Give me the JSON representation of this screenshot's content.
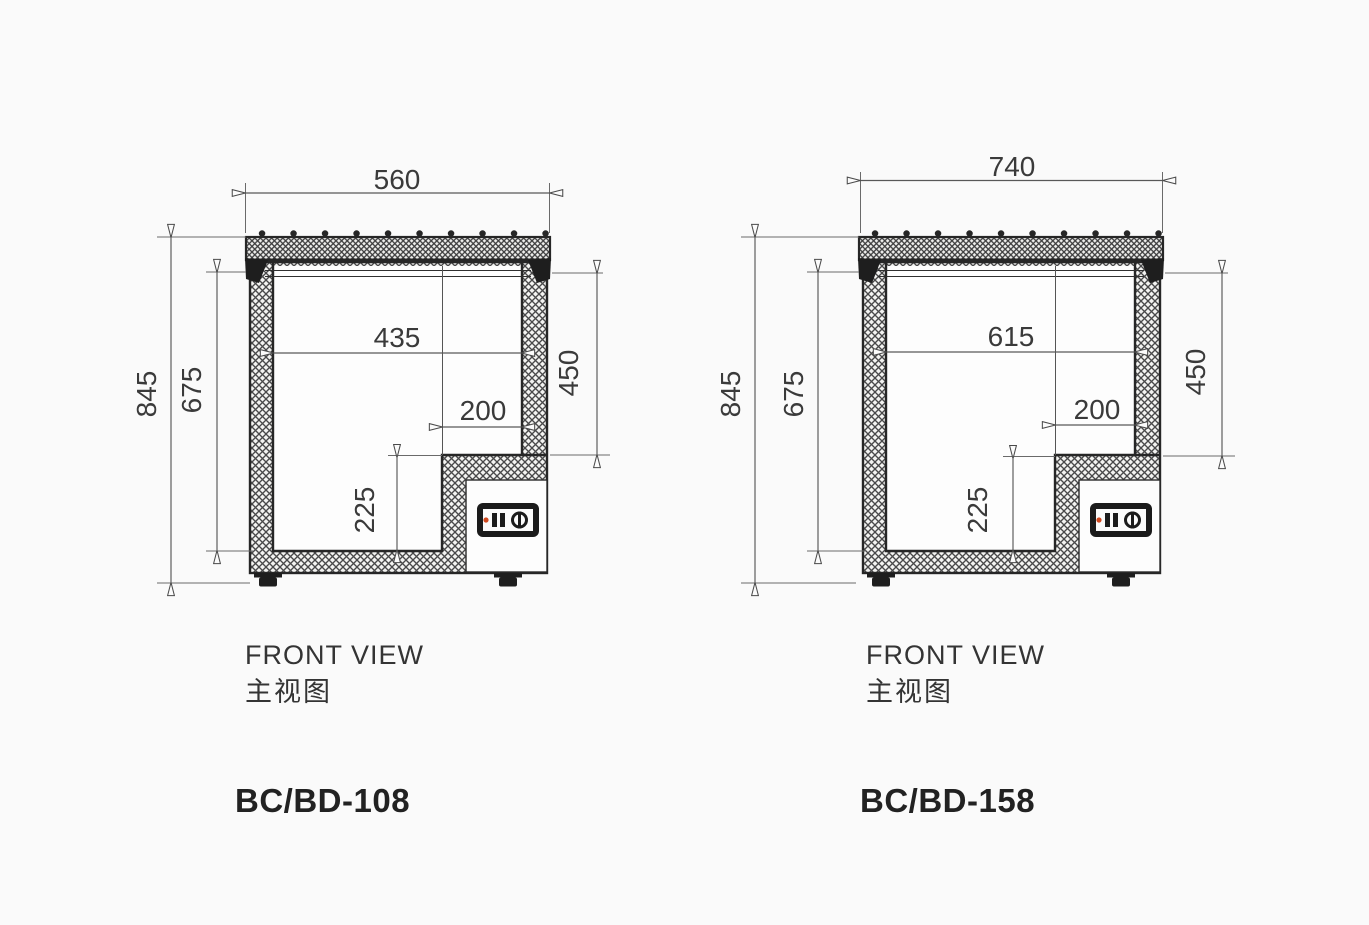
{
  "page": {
    "background": "#fafafa",
    "line_color": "#262626",
    "dim_line_color": "#585858",
    "accent_red": "#d1491f"
  },
  "drawings": [
    {
      "model": "BC/BD-108",
      "view_label_en": "FRONT VIEW",
      "view_label_zh": "主视图",
      "dims": {
        "overall_width": "560",
        "overall_height": "845",
        "inner_depth": "675",
        "inner_width": "435",
        "right_inner_depth": "450",
        "step_width": "200",
        "step_height": "225"
      }
    },
    {
      "model": "BC/BD-158",
      "view_label_en": "FRONT VIEW",
      "view_label_zh": "主视图",
      "dims": {
        "overall_width": "740",
        "overall_height": "845",
        "inner_depth": "675",
        "inner_width": "615",
        "right_inner_depth": "450",
        "step_width": "200",
        "step_height": "225"
      }
    }
  ]
}
